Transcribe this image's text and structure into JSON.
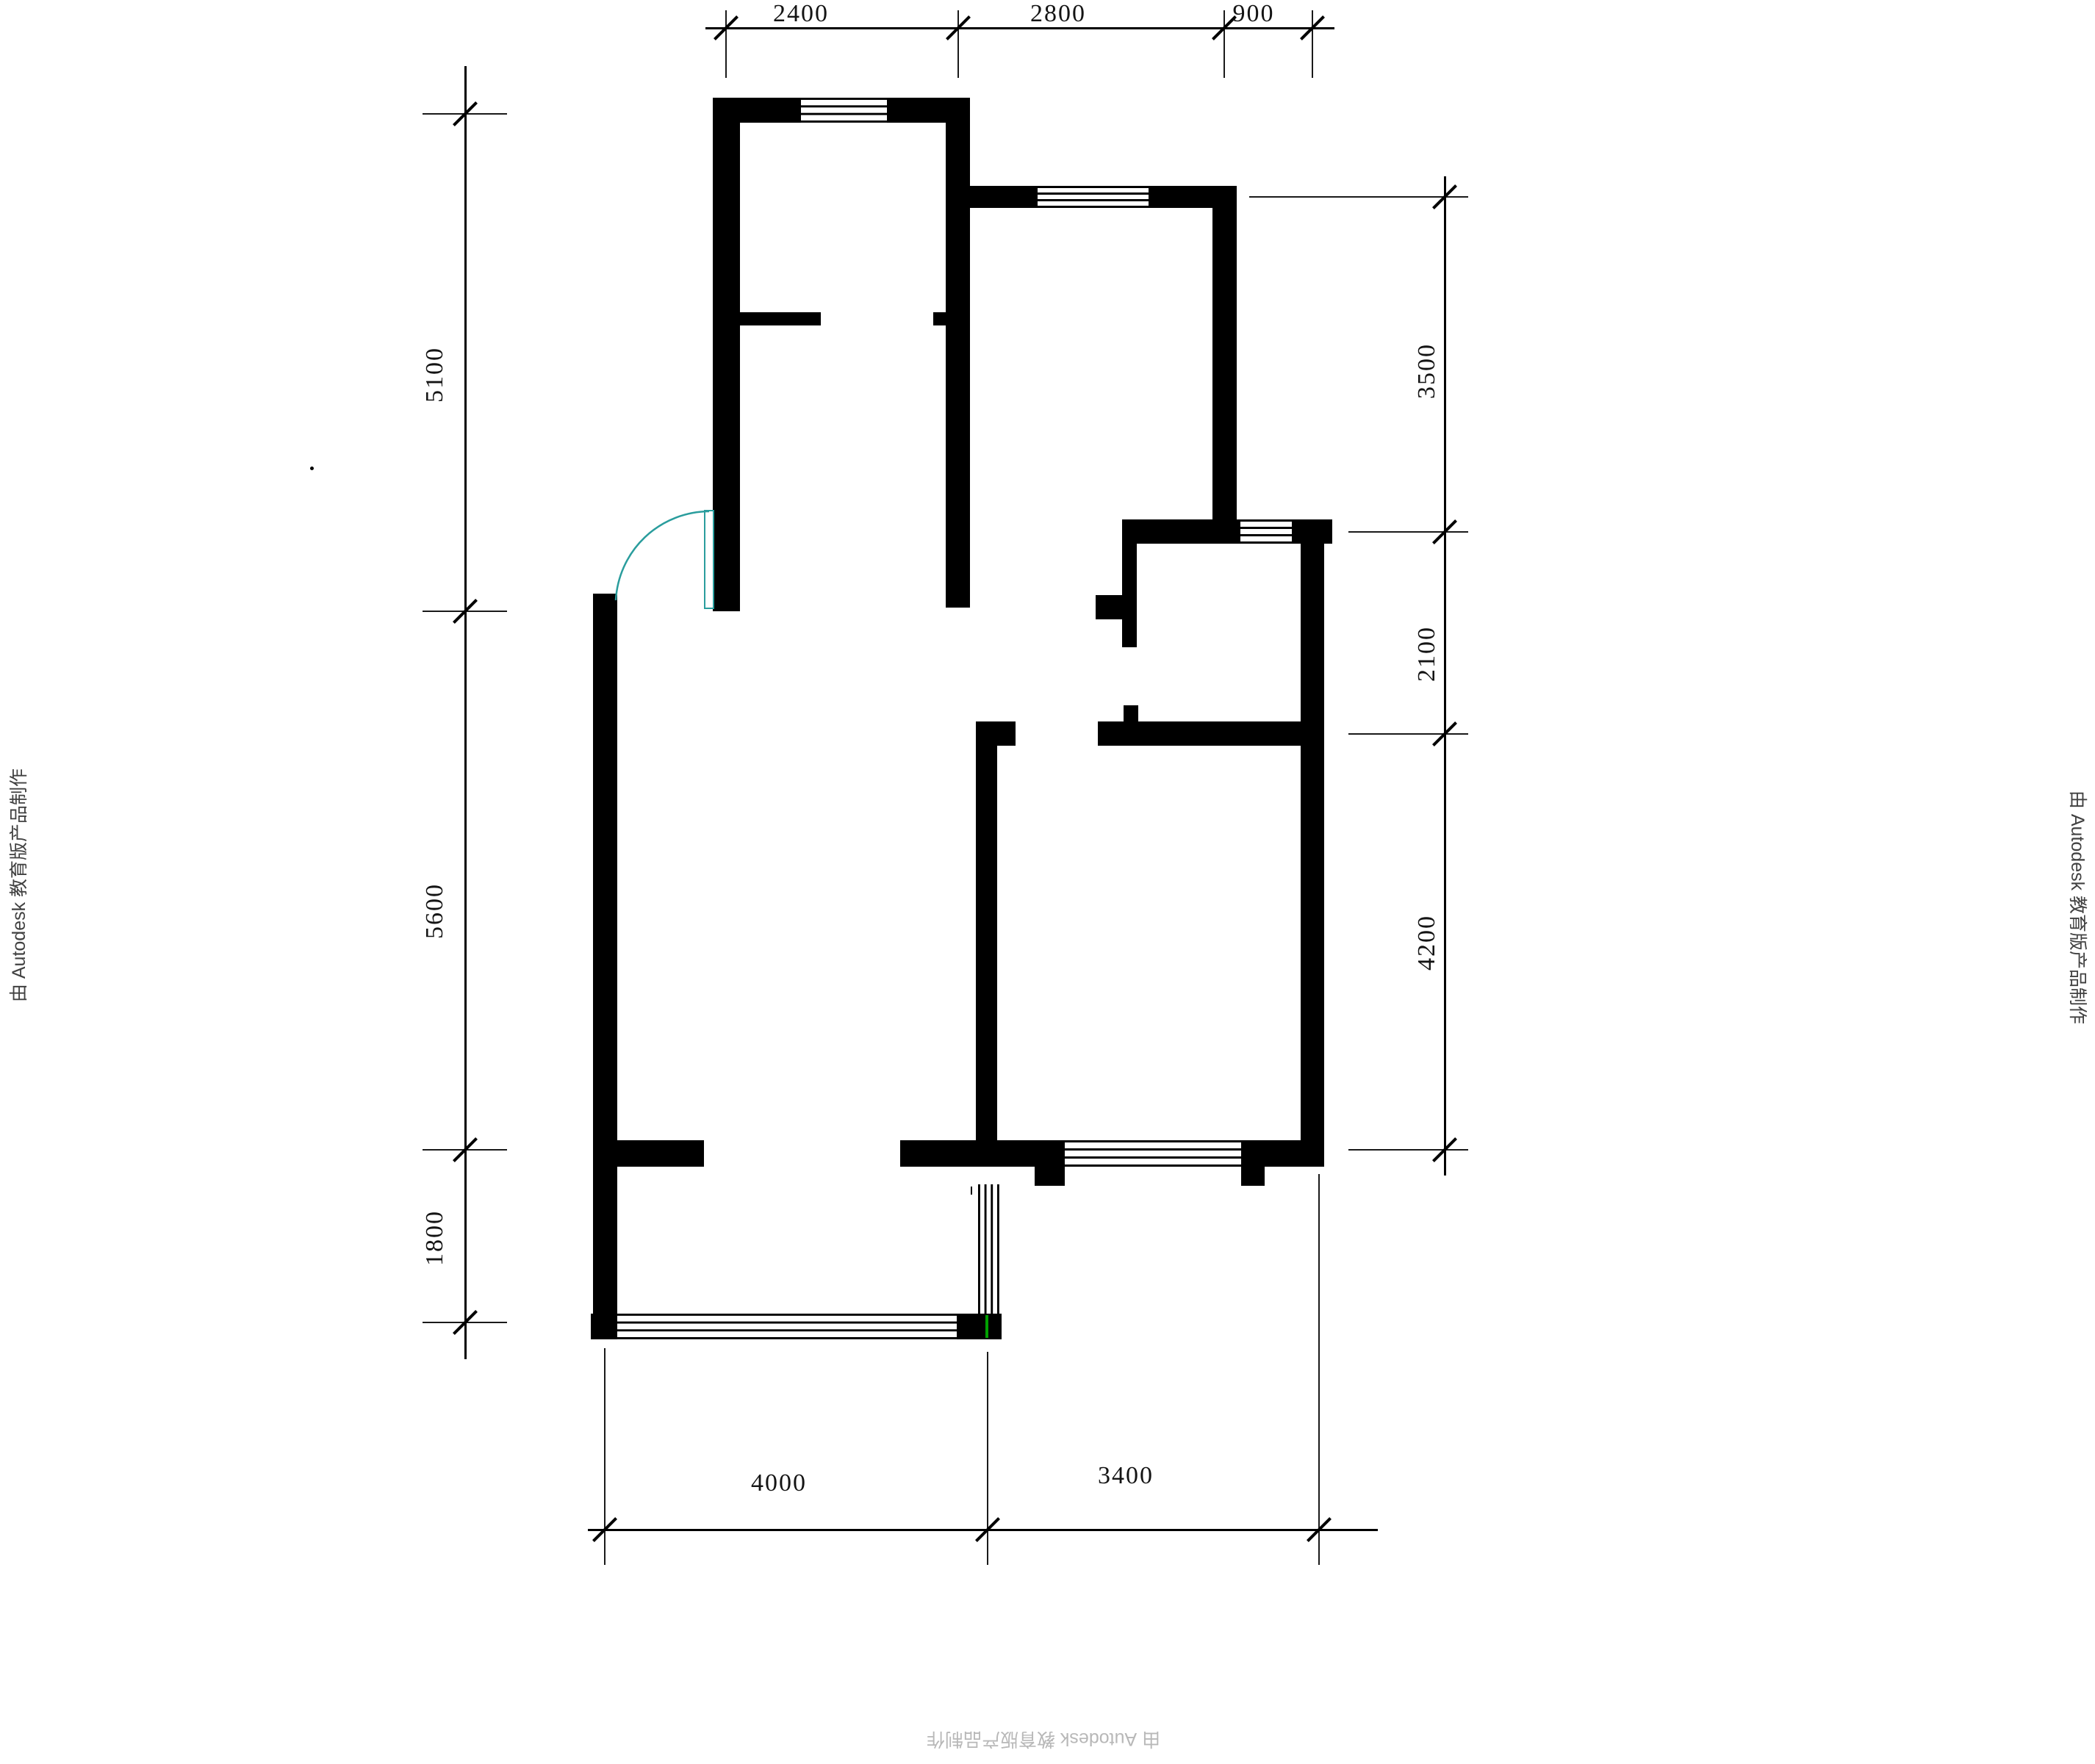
{
  "watermarks": {
    "left": "由 Autodesk 教育版产品制作",
    "right": "由 Autodesk 教育版产品制作",
    "bottom": "由 Autodesk 教育版产品制作"
  },
  "dimensions": {
    "top": [
      "2400",
      "2800",
      "900"
    ],
    "left": [
      "5100",
      "5600",
      "1800"
    ],
    "right": [
      "3500",
      "2100",
      "4200"
    ],
    "bottom": [
      "4000",
      "3400"
    ]
  },
  "colors": {
    "wall": "#000000",
    "door": "#2a9d9d",
    "accent_green": "#00a000",
    "dim_text": "#141414",
    "watermark_side": "#414141",
    "watermark_bottom": "#b8b8b8"
  }
}
